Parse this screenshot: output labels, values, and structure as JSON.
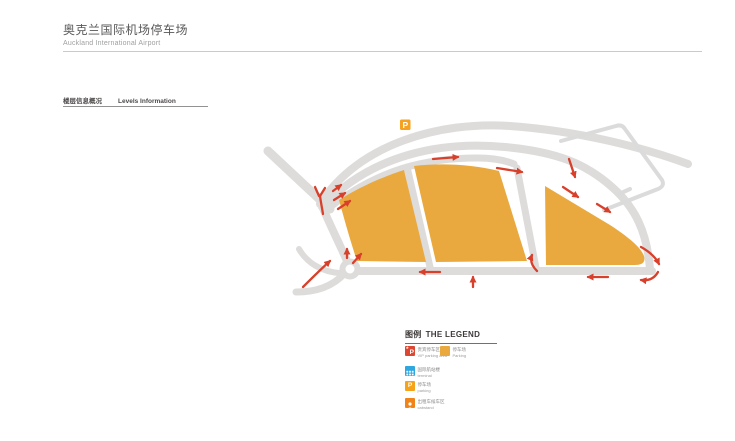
{
  "header": {
    "title_zh": "奥克兰国际机场停车场",
    "title_en": "Auckland International Airport"
  },
  "section": {
    "label_zh": "楼层信息概况",
    "label_en": "Levels Information"
  },
  "map": {
    "p_marker_label": "P",
    "colors": {
      "road": "#DDDCDA",
      "parking_fill": "#E9A93F",
      "arrow_red": "#D8402C",
      "terminal_outline": "#DBDBDB",
      "p_marker_bg": "#F5A122"
    }
  },
  "legend": {
    "title_zh": "图例",
    "title_en": "THE LEGEND",
    "items": [
      {
        "name": "vip-parking-area",
        "color": "#DC4731",
        "icon_label": "P",
        "badge": "★",
        "zh": "贵宾停车区",
        "en": "VIP parking area"
      },
      {
        "name": "parking-area",
        "color": "#E9A93F",
        "zh": "停车场",
        "en": "Parking"
      },
      {
        "name": "terminal",
        "color": "#2EA7DF",
        "zh": "国际航站楼",
        "en": "terminal"
      },
      {
        "name": "parking",
        "color": "#F6A31C",
        "icon_label": "P",
        "zh": "停车场",
        "en": "parking"
      },
      {
        "name": "cabstand",
        "color": "#F08418",
        "zh": "出租车候车区",
        "en": "cabstand"
      }
    ]
  }
}
